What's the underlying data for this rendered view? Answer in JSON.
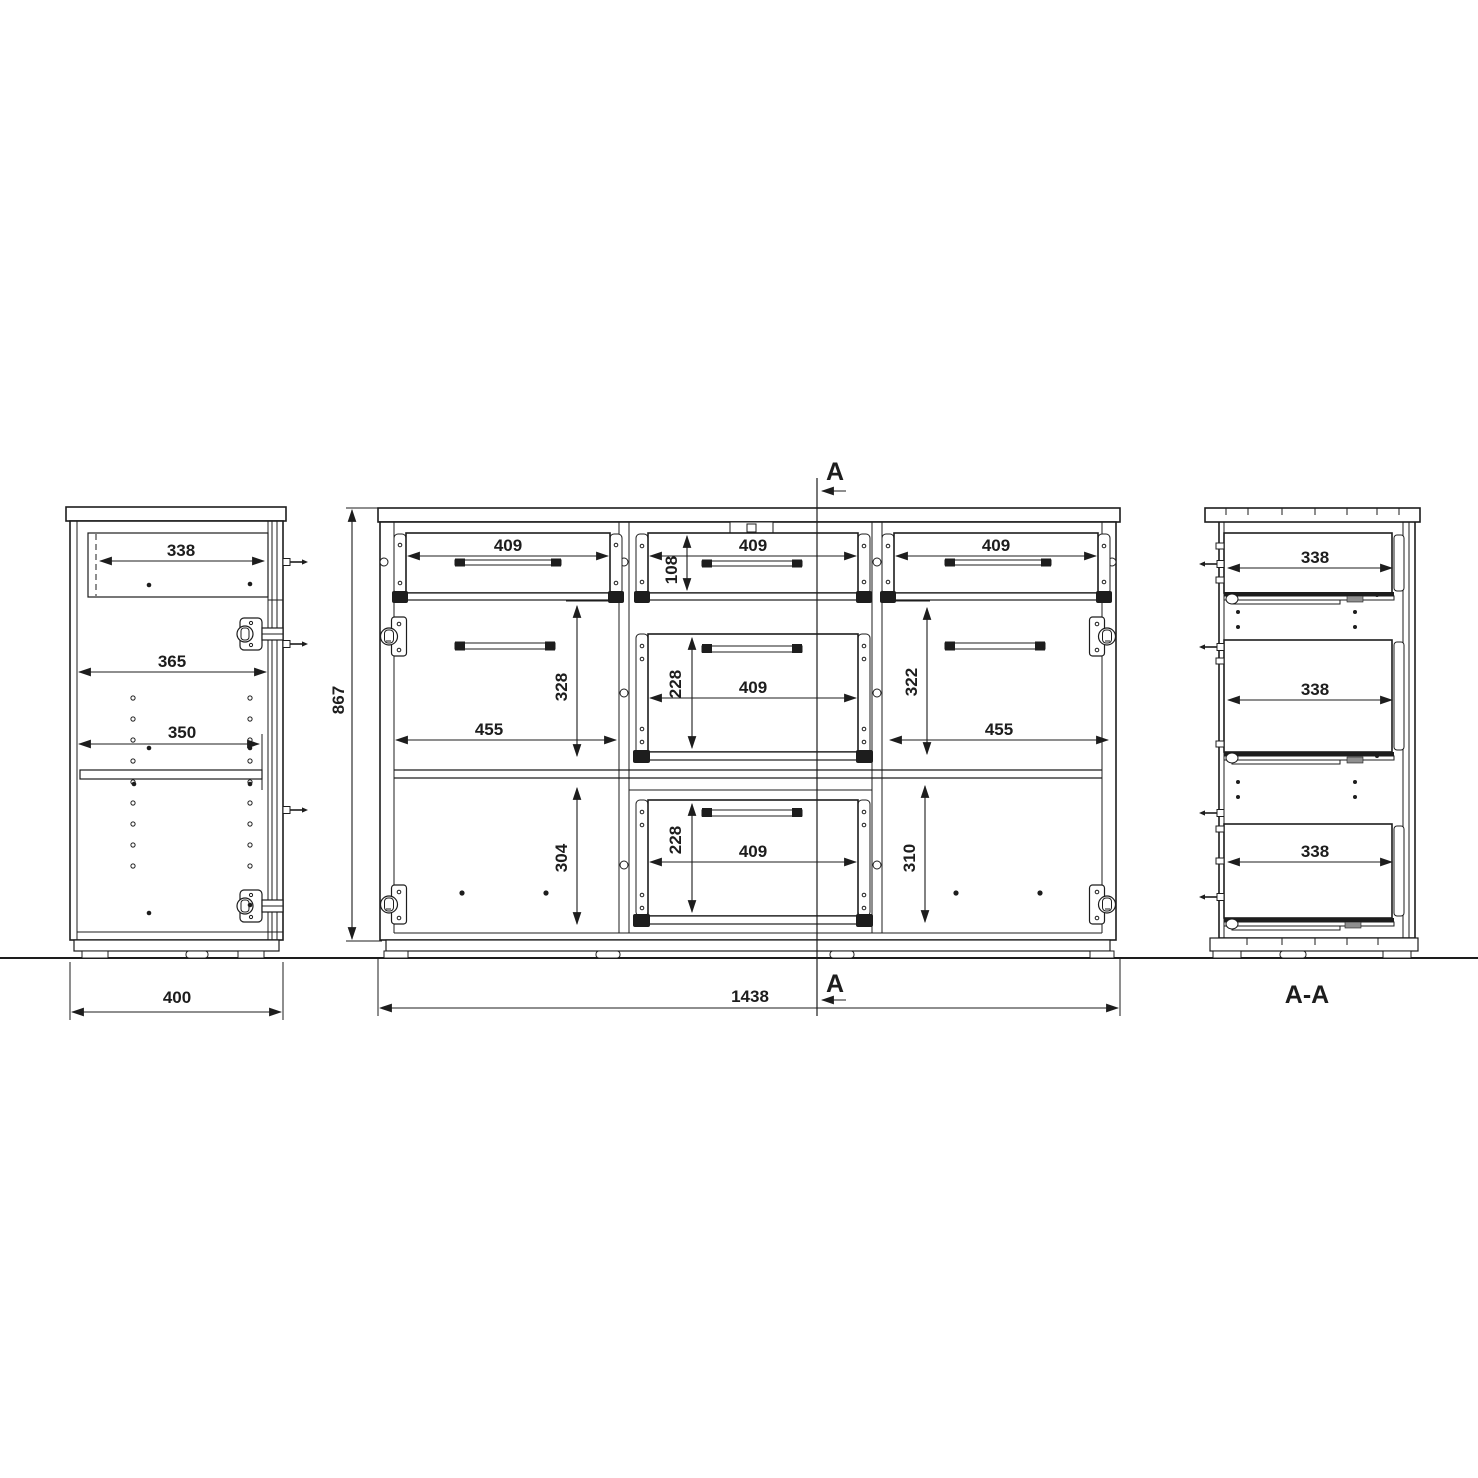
{
  "drawing_type": "furniture-technical-drawing",
  "colors": {
    "line": "#1d1d1d",
    "background": "#ffffff"
  },
  "side_view": {
    "dims": {
      "drawer_width": "338",
      "interior_width": "365",
      "shelf_width": "350",
      "depth": "400"
    }
  },
  "front_view": {
    "dims": {
      "height": "867",
      "width": "1438",
      "drawer_top_left_width": "409",
      "drawer_top_mid_width": "409",
      "drawer_top_right_width": "409",
      "drawer_top_height": "108",
      "drawer_mid_height": "228",
      "drawer_mid_width": "409",
      "drawer_bottom_height": "228",
      "drawer_bottom_width": "409",
      "left_compartment_width": "455",
      "left_upper_height": "328",
      "left_lower_height": "304",
      "right_compartment_width": "455",
      "right_upper_height": "322",
      "right_lower_height": "310"
    }
  },
  "section": {
    "marker_top": "A",
    "marker_bottom": "A",
    "view_title": "A-A",
    "dims": {
      "drawer_top_depth": "338",
      "drawer_mid_depth": "338",
      "drawer_bottom_depth": "338"
    }
  }
}
